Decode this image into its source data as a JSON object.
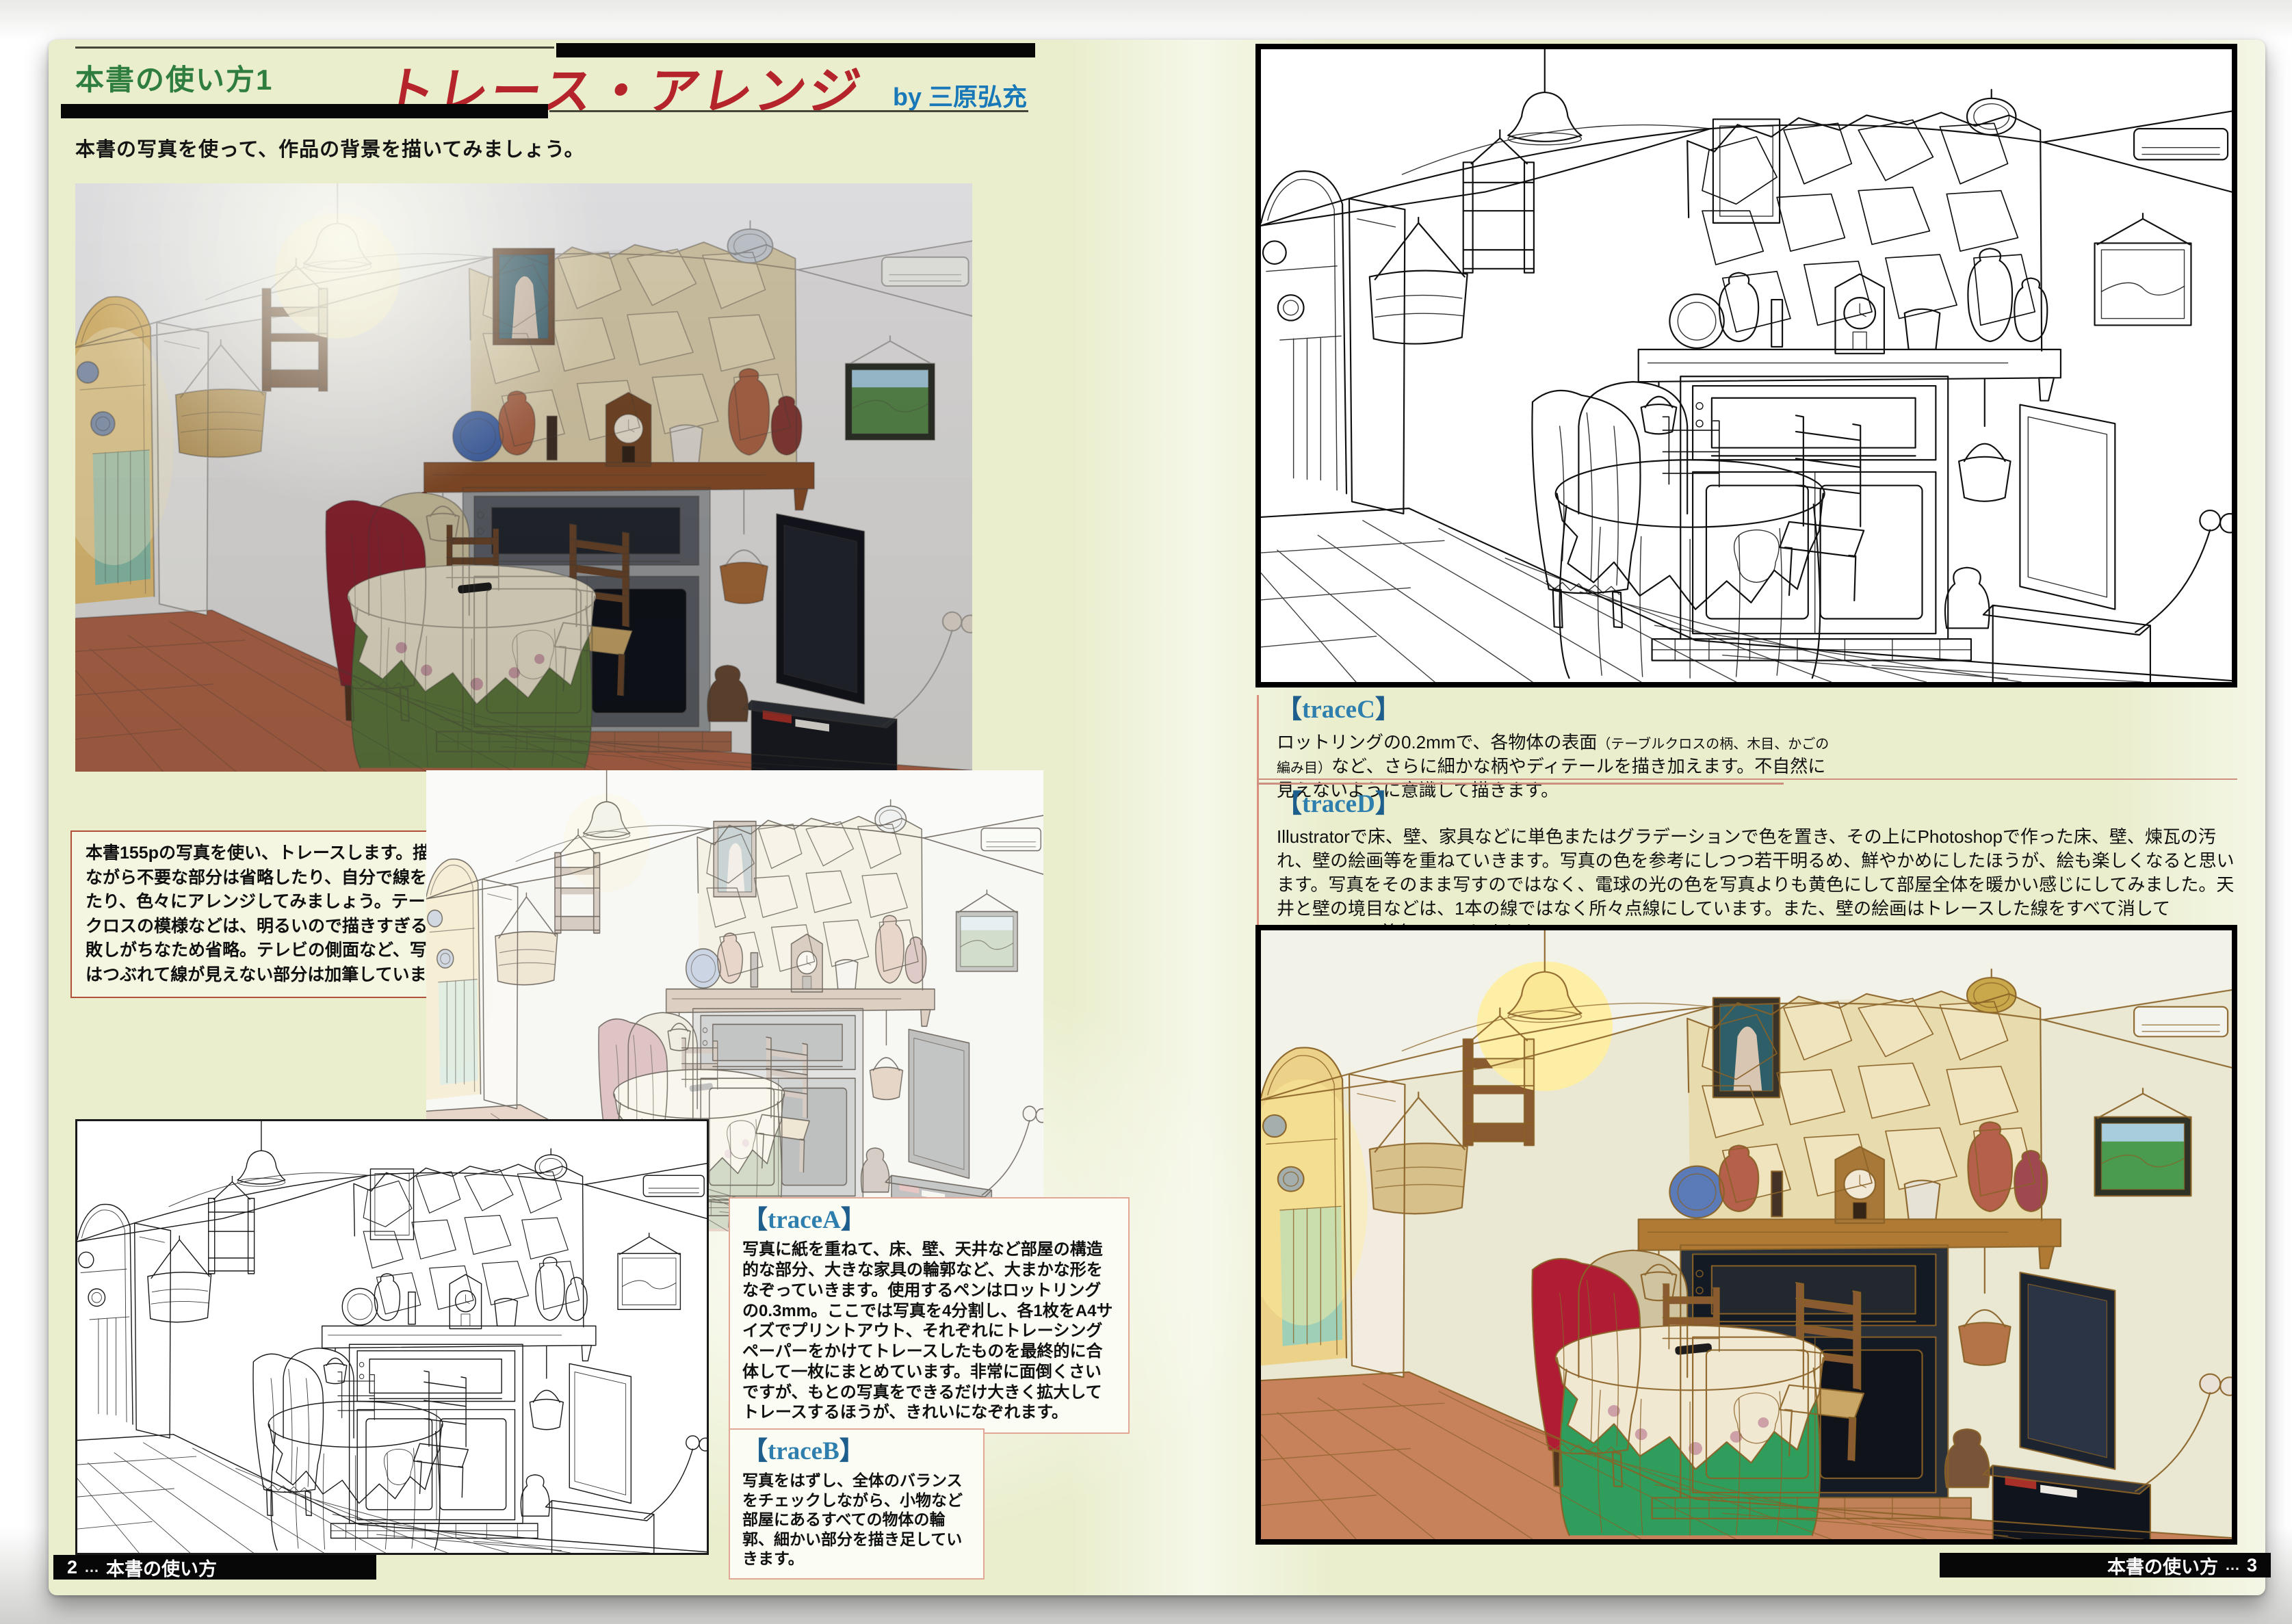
{
  "ui": {
    "bracket_open": "【",
    "bracket_close": "】"
  },
  "left_page": {
    "kicker": "本書の使い方1",
    "title": "トレース・アレンジ",
    "byline": "by 三原弘充",
    "lede": "本書の写真を使って、作品の背景を描いてみましょう。",
    "photo_note": "本書155pの写真を使い、トレースします。描きながら不要な部分は省略したり、自分で線を加えたり、色々にアレンジしてみましょう。テーブルクロスの模様などは、明るいので描きすぎると失敗しがちなため省略。テレビの側面など、写真ではつぶれて線が見えない部分は加筆しています。",
    "sections": [
      {
        "id": "traceA",
        "label": "traceA",
        "body": "写真に紙を重ねて、床、壁、天井など部屋の構造的な部分、大きな家具の輪郭など、大まかな形をなぞっていきます。使用するペンはロットリングの0.3mm。ここでは写真を4分割し、各1枚をA4サイズでプリントアウト、それぞれにトレーシングペーパーをかけてトレースしたものを最終的に合体して一枚にまとめています。非常に面倒くさいですが、もとの写真をできるだけ大きく拡大してトレースするほうが、きれいになぞれます。"
      },
      {
        "id": "traceB",
        "label": "traceB",
        "body": "写真をはずし、全体のバランスをチェックしながら、小物など部屋にあるすべての物体の輪郭、細かい部分を描き足していきます。"
      }
    ],
    "footer": {
      "number": "2",
      "separator": "…",
      "label": "本書の使い方"
    }
  },
  "right_page": {
    "sections": [
      {
        "id": "traceC",
        "label": "traceC",
        "body_pre": "ロットリングの0.2mmで、各物体の表面",
        "paren": "（テーブルクロスの柄、木目、かごの編み目）",
        "body_post": "など、さらに細かな柄やディテールを描き加えます。不自然に見えないように意識して描きます。"
      },
      {
        "id": "traceD",
        "label": "traceD",
        "body": "Illustratorで床、壁、家具などに単色またはグラデーションで色を置き、その上にPhotoshopで作った床、壁、煉瓦の汚れ、壁の絵画等を重ねていきます。写真の色を参考にしつつ若干明るめ、鮮やかめにしたほうが、絵も楽しくなると思います。写真をそのまま写すのではなく、電球の光の色を写真よりも黄色にして部屋全体を暖かい感じにしてみました。天井と壁の境目などは、1本の線ではなく所々点線にしています。また、壁の絵画はトレースした線をすべて消してPhotoshopの着色のみにしました。"
      }
    ],
    "footer": {
      "label": "本書の使い方",
      "separator": "…",
      "number": "3"
    }
  },
  "colors": {
    "page_bg": "#eaeecd",
    "kicker_green": "#2f7d3f",
    "title_red": "#b5242a",
    "byline_blue": "#1878b8",
    "heading_blue": "#2f7fae",
    "bracket_blue": "#1d5e8c",
    "note_border": "#b0503a",
    "trace_box_border": "#e2a896",
    "rule_pink": "#cc9080",
    "footer_bg": "#070707",
    "footer_text": "#ffffff"
  }
}
